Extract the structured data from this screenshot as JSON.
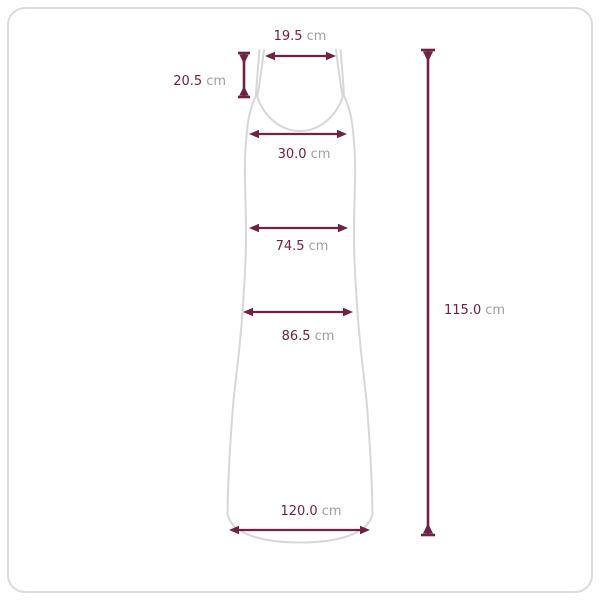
{
  "diagram_type": "garment-size-spec",
  "garment": "sleeveless-maxi-dress",
  "colors": {
    "measure": "#6e2345",
    "unit_text": "#9da0a3",
    "outline": "#d7d7d8",
    "frame_border": "#dcdcdc"
  },
  "measurements": {
    "strap_width": {
      "value": "19.5",
      "unit": "cm"
    },
    "strap_length": {
      "value": "20.5",
      "unit": "cm"
    },
    "bust_width": {
      "value": "30.0",
      "unit": "cm"
    },
    "waist_width": {
      "value": "74.5",
      "unit": "cm"
    },
    "hip_width": {
      "value": "86.5",
      "unit": "cm"
    },
    "hem_width": {
      "value": "120.0",
      "unit": "cm"
    },
    "total_length": {
      "value": "115.0",
      "unit": "cm"
    }
  }
}
